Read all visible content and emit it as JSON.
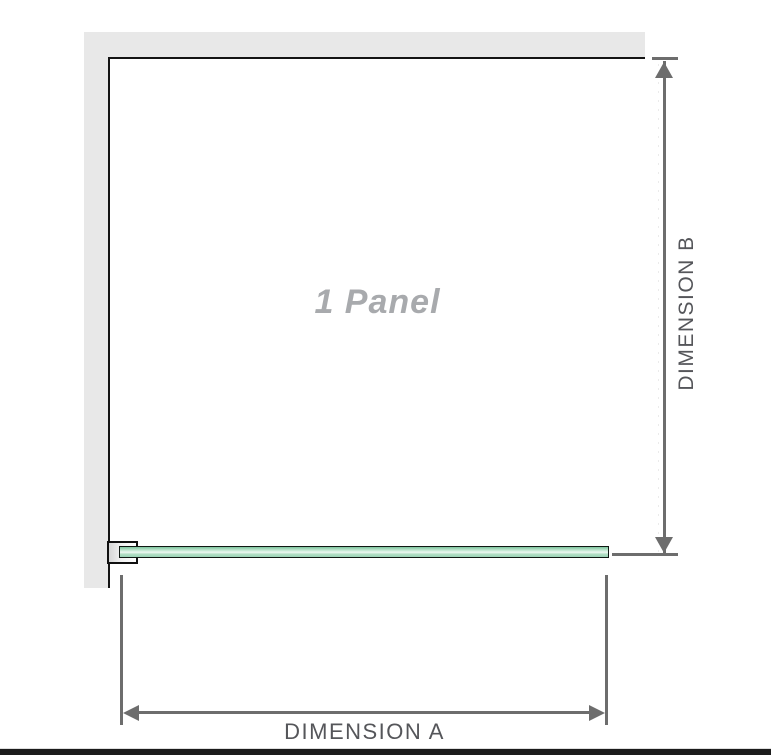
{
  "diagram": {
    "panel_label": "1 Panel",
    "dimensions": {
      "a": {
        "label": "DIMENSION A"
      },
      "b": {
        "label": "DIMENSION B"
      }
    }
  },
  "colors": {
    "wall": "#e8e8e8",
    "outline": "#141414",
    "glass-light": "#eef9f2",
    "glass-green": "#9ad3b6",
    "glass-green-dark": "#7cc59d",
    "dim-line": "#6d6d6d",
    "dim-text": "#55565a",
    "panel-text": "#a8aaad",
    "footer": "#1c1c1c"
  }
}
